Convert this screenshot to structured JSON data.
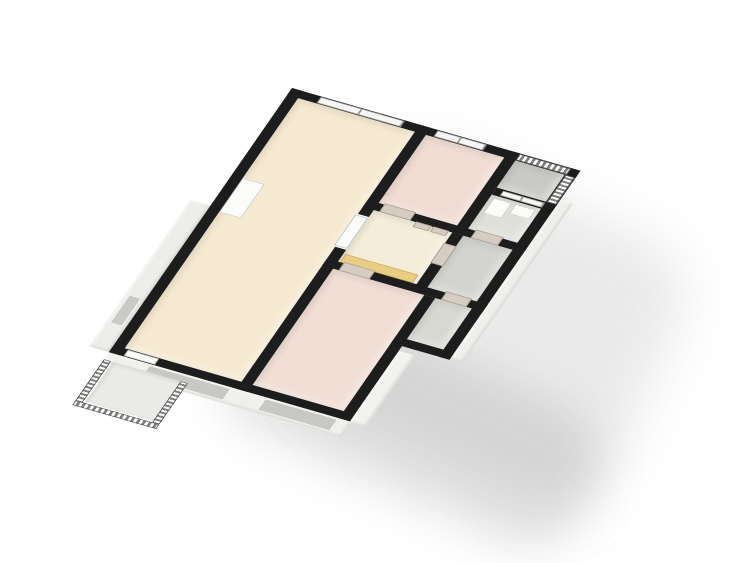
{
  "scene": {
    "description": "3D isometric floor plan of an apartment, no text labels visible",
    "background_color": "#ffffff",
    "wall_cut_color": "#1d1d1d",
    "exterior_face_color": "#f0f0ec",
    "shadow_color": "#969696"
  },
  "plan": {
    "layer_order": [
      "exterior",
      "porch",
      "floors",
      "furniture",
      "walls",
      "windows",
      "railings",
      "doors"
    ],
    "layers": {
      "exterior": [
        {
          "name": "exterior-face-bottom",
          "x": 0,
          "y": 450,
          "w": 266,
          "h": 26,
          "color": "#f0f0ec"
        },
        {
          "name": "facade-window-living",
          "kind": "hole",
          "x": 45,
          "y": 452,
          "w": 90,
          "h": 20,
          "color": "#c7c7c3"
        },
        {
          "name": "facade-window-bedroom-lower",
          "kind": "hole",
          "x": 172,
          "y": 452,
          "w": 80,
          "h": 20,
          "color": "#c7c7c3"
        },
        {
          "name": "exterior-face-left",
          "x": -22,
          "y": 200,
          "w": 22,
          "h": 250,
          "color": "#ededea"
        },
        {
          "name": "facade-door-left",
          "kind": "hole",
          "x": -18,
          "y": 360,
          "w": 14,
          "h": 48,
          "color": "#c9c9c5"
        },
        {
          "name": "exterior-face-right-lower",
          "x": 264,
          "y": 330,
          "w": 18,
          "h": 122,
          "color": "#f2f2ee"
        },
        {
          "name": "exterior-face-right-upper",
          "x": 316,
          "y": 50,
          "w": 14,
          "h": 270,
          "color": "#efefeb"
        }
      ],
      "porch": [
        {
          "name": "entry-porch-platform",
          "x": 10,
          "y": 462,
          "w": 74,
          "h": 68,
          "color": "#eaeae6"
        }
      ],
      "floors": [
        {
          "name": "living-room-floor",
          "x": 12,
          "y": 12,
          "w": 128,
          "h": 426,
          "color": "#f6e9d1"
        },
        {
          "name": "bedroom-upper-floor",
          "x": 152,
          "y": 12,
          "w": 86,
          "h": 116,
          "color": "#f0dcd3"
        },
        {
          "name": "balcony-upper-floor",
          "x": 250,
          "y": 12,
          "w": 54,
          "h": 46,
          "color": "#c9c9c5"
        },
        {
          "name": "bathroom-floor",
          "x": 250,
          "y": 70,
          "w": 54,
          "h": 58,
          "color": "#e0e0db"
        },
        {
          "name": "hallway-floor",
          "x": 152,
          "y": 140,
          "w": 86,
          "h": 88,
          "color": "#f4edda"
        },
        {
          "name": "wc-floor",
          "x": 250,
          "y": 140,
          "w": 54,
          "h": 88,
          "color": "#d3d3cf"
        },
        {
          "name": "bedroom-lower-floor",
          "x": 152,
          "y": 240,
          "w": 100,
          "h": 198,
          "color": "#f1ded5"
        },
        {
          "name": "storage-annex-floor",
          "x": 264,
          "y": 240,
          "w": 40,
          "h": 70,
          "color": "#d8d8d3"
        }
      ],
      "furniture": [
        {
          "name": "kitchen-counter",
          "kind": "wood",
          "x": 154,
          "y": 214,
          "w": 80,
          "h": 14,
          "color": "#e9cd85"
        },
        {
          "name": "washing-machine",
          "kind": "white",
          "x": 254,
          "y": 74,
          "w": 20,
          "h": 26
        },
        {
          "name": "bathroom-sink",
          "kind": "white",
          "x": 278,
          "y": 74,
          "w": 22,
          "h": 16
        },
        {
          "name": "living-room-wardrobe",
          "kind": "white",
          "x": 12,
          "y": 148,
          "w": 24,
          "h": 58
        }
      ],
      "walls": [
        {
          "name": "wall-top",
          "x": 0,
          "y": 0,
          "w": 316,
          "h": 12
        },
        {
          "name": "wall-left",
          "x": 0,
          "y": 0,
          "w": 12,
          "h": 450
        },
        {
          "name": "wall-bottom",
          "x": 0,
          "y": 438,
          "w": 264,
          "h": 12
        },
        {
          "name": "wall-right-upper",
          "x": 304,
          "y": 0,
          "w": 12,
          "h": 322
        },
        {
          "name": "wall-living-right-upper",
          "x": 140,
          "y": 0,
          "w": 12,
          "h": 152
        },
        {
          "name": "wall-living-right-lower",
          "x": 140,
          "y": 208,
          "w": 12,
          "h": 242
        },
        {
          "name": "wall-divider-upper-rooms",
          "x": 140,
          "y": 128,
          "w": 176,
          "h": 12
        },
        {
          "name": "wall-divider-lower-rooms",
          "x": 140,
          "y": 228,
          "w": 176,
          "h": 12
        },
        {
          "name": "wall-bedroom-bathroom",
          "x": 238,
          "y": 0,
          "w": 12,
          "h": 140
        },
        {
          "name": "wall-hallway-wc",
          "x": 238,
          "y": 140,
          "w": 12,
          "h": 100
        },
        {
          "name": "wall-balcony-divider",
          "x": 250,
          "y": 58,
          "w": 66,
          "h": 12
        },
        {
          "name": "wall-annex-left",
          "x": 252,
          "y": 240,
          "w": 12,
          "h": 210
        },
        {
          "name": "wall-annex-bottom",
          "x": 252,
          "y": 310,
          "w": 64,
          "h": 12
        }
      ],
      "windows": [
        {
          "name": "living-room-window",
          "x": 32,
          "y": 1,
          "w": 92,
          "h": 10,
          "panes": 2
        },
        {
          "name": "bedroom-upper-window",
          "x": 160,
          "y": 1,
          "w": 54,
          "h": 10,
          "panes": 2
        },
        {
          "name": "balcony-glass-door",
          "x": 258,
          "y": 60,
          "w": 46,
          "h": 8,
          "panes": 2
        }
      ],
      "railings": [
        {
          "name": "balcony-railing-top",
          "kind": "rail-h",
          "x": 250,
          "y": 1,
          "w": 56,
          "h": 10
        },
        {
          "name": "balcony-railing-right",
          "kind": "rail-v",
          "x": 305,
          "y": 12,
          "w": 10,
          "h": 46
        },
        {
          "name": "porch-railing-left",
          "kind": "rail-v",
          "x": 0,
          "y": 462,
          "w": 8,
          "h": 78
        },
        {
          "name": "porch-railing-bottom",
          "kind": "rail-h",
          "x": 0,
          "y": 532,
          "w": 92,
          "h": 8
        },
        {
          "name": "porch-railing-right",
          "kind": "rail-v",
          "x": 84,
          "y": 462,
          "w": 8,
          "h": 70
        }
      ],
      "doors": [
        {
          "name": "bedroom-upper-door",
          "kind": "tan",
          "x": 158,
          "y": 126,
          "w": 34,
          "h": 14
        },
        {
          "name": "bathroom-door",
          "kind": "tan",
          "x": 258,
          "y": 126,
          "w": 30,
          "h": 14
        },
        {
          "name": "closet-door-left",
          "kind": "tan",
          "x": 198,
          "y": 139,
          "w": 17,
          "h": 9
        },
        {
          "name": "closet-door-right",
          "kind": "tan",
          "x": 217,
          "y": 139,
          "w": 17,
          "h": 9
        },
        {
          "name": "wc-door",
          "kind": "tan",
          "x": 237,
          "y": 158,
          "w": 14,
          "h": 34
        },
        {
          "name": "bedroom-lower-door",
          "kind": "tan",
          "x": 158,
          "y": 226,
          "w": 34,
          "h": 14
        },
        {
          "name": "storage-annex-door",
          "kind": "tan",
          "x": 270,
          "y": 226,
          "w": 28,
          "h": 14
        },
        {
          "name": "living-hallway-door",
          "kind": "white",
          "x": 138,
          "y": 154,
          "w": 14,
          "h": 52
        },
        {
          "name": "entrance-door",
          "kind": "white",
          "x": 16,
          "y": 439,
          "w": 34,
          "h": 10
        }
      ]
    }
  }
}
